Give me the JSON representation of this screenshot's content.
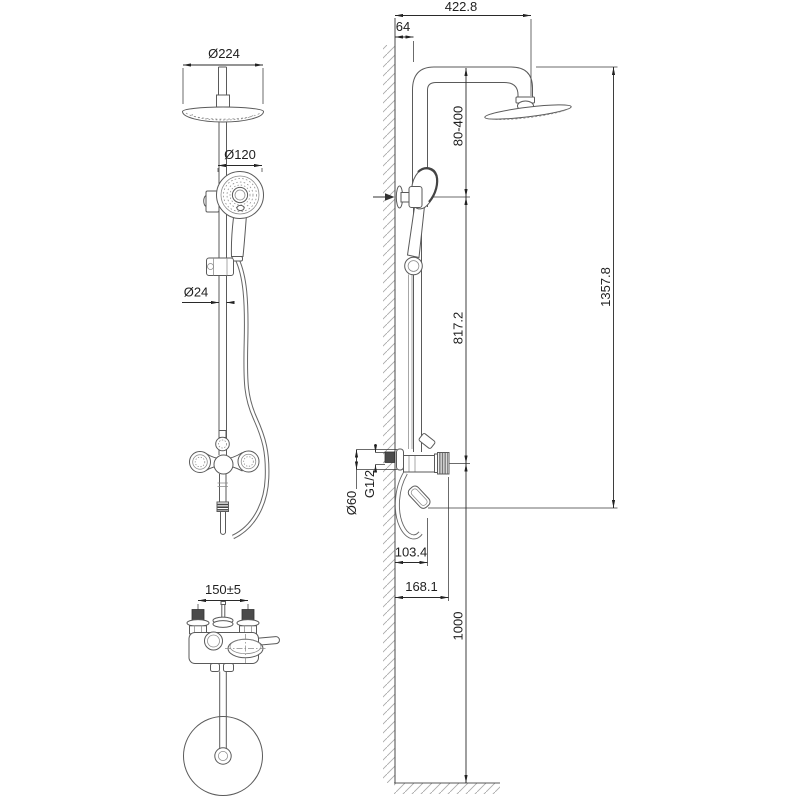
{
  "title": "Shower column technical drawing",
  "colors": {
    "line": "#5a5a5a",
    "dimension": "#2a2a2a",
    "hatch": "#aaaaaa",
    "dark_fill": "#4b4b4b",
    "background": "#ffffff"
  },
  "drawing": {
    "front_view": {
      "head_diameter": "Ø224",
      "hand_shower_diameter": "Ø120",
      "rail_diameter": "Ø24"
    },
    "plan_view": {
      "connection_spacing": "150±5"
    },
    "side_view": {
      "head_offset_from_wall": "422.8",
      "wall_to_rail": "64",
      "holder_adjust_range": "80-400",
      "overall_height": "1357.8",
      "rail_height": "817.2",
      "inlet_thread": "G1/2",
      "escutcheon_diameter": "Ø60",
      "spout_reach": "103.4",
      "handle_reach": "168.1",
      "mixer_mount_height": "1000"
    }
  }
}
